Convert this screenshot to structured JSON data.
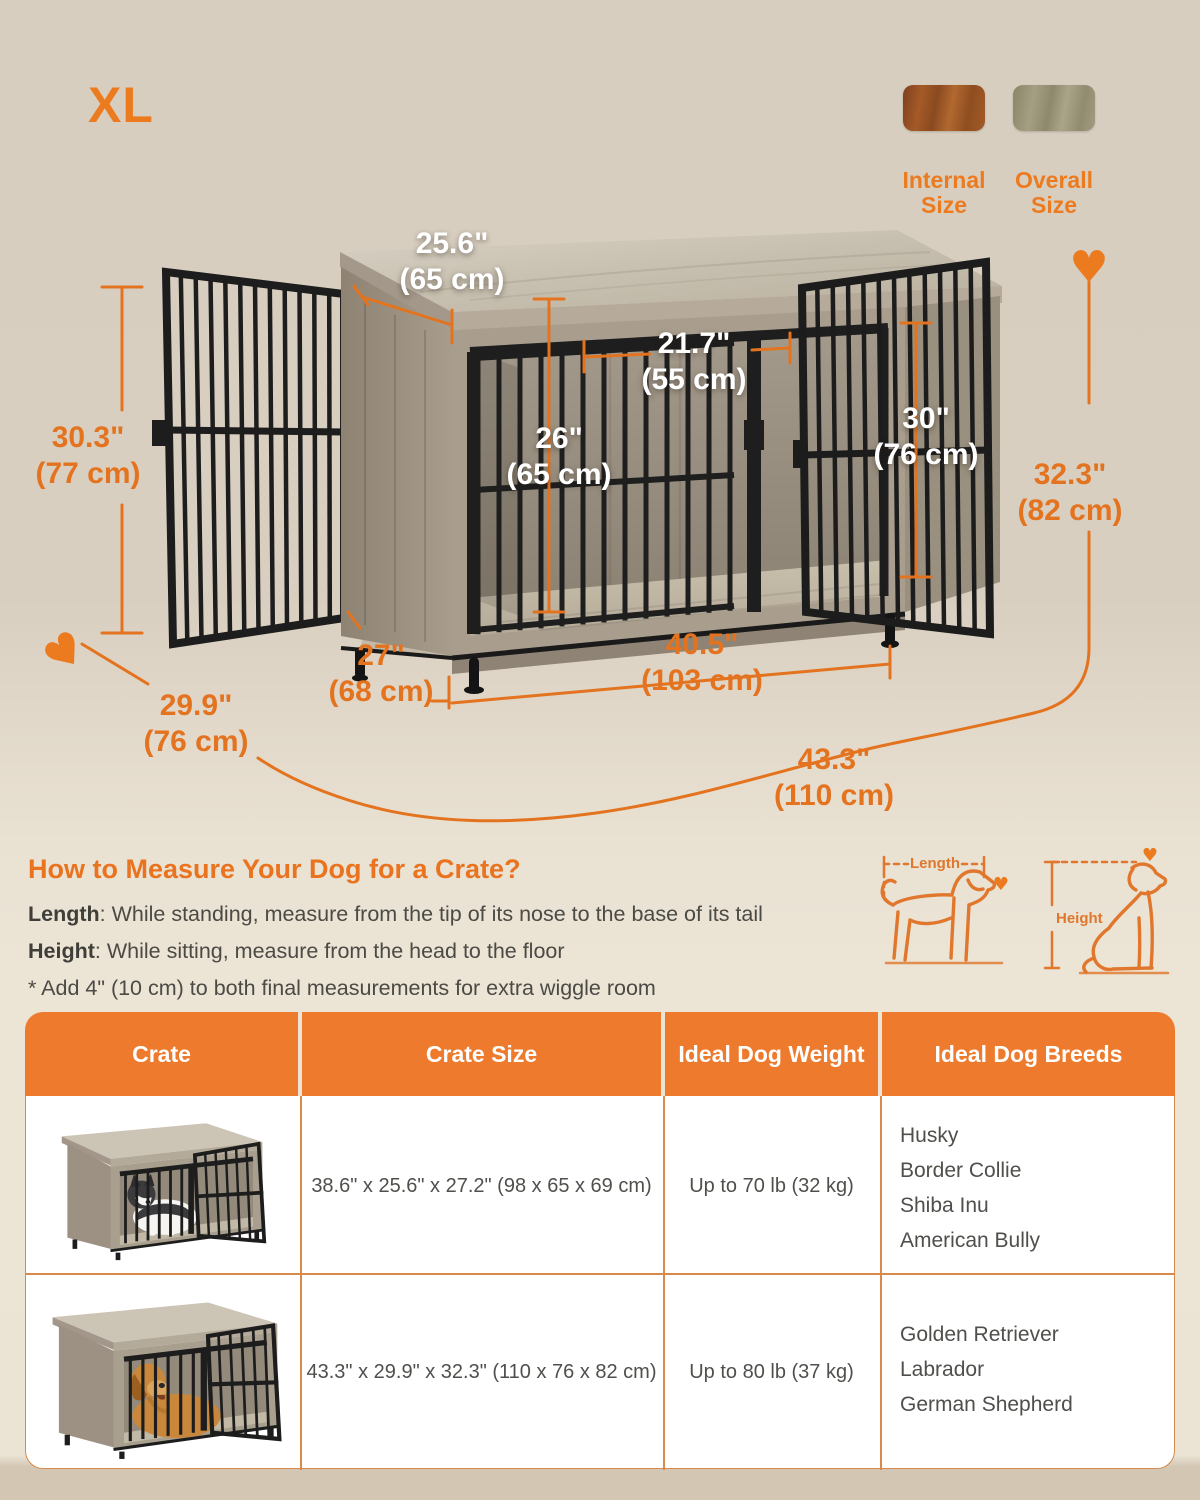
{
  "page": {
    "size_label": "XL"
  },
  "legend": {
    "internal": {
      "label": "Internal Size"
    },
    "overall": {
      "label": "Overall Size"
    }
  },
  "dimensions": {
    "top_depth": {
      "in": "25.6\"",
      "cm": "(65 cm)"
    },
    "door_width": {
      "in": "21.7\"",
      "cm": "(55 cm)"
    },
    "inner_height": {
      "in": "26\"",
      "cm": "(65 cm)"
    },
    "door_height": {
      "in": "30\"",
      "cm": "(76 cm)"
    },
    "left_height": {
      "in": "30.3\"",
      "cm": "(77 cm)"
    },
    "overall_height": {
      "in": "32.3\"",
      "cm": "(82 cm)"
    },
    "inner_depth": {
      "in": "27\"",
      "cm": "(68 cm)"
    },
    "inner_width": {
      "in": "40.5\"",
      "cm": "(103 cm)"
    },
    "overall_depth": {
      "in": "29.9\"",
      "cm": "(76 cm)"
    },
    "overall_width": {
      "in": "43.3\"",
      "cm": "(110 cm)"
    }
  },
  "measure": {
    "title": "How to Measure Your Dog for a Crate?",
    "length_label": "Length",
    "length_text": ":  While standing, measure from the tip of its nose to the base of its tail",
    "height_label": "Height",
    "height_text": ": While sitting, measure from the head to the floor",
    "note": "* Add 4\" (10 cm) to both final measurements for extra wiggle room",
    "diagram": {
      "length_label": "Length",
      "height_label": "Height"
    }
  },
  "table": {
    "headers": [
      "Crate",
      "Crate Size",
      "Ideal Dog Weight",
      "Ideal Dog Breeds"
    ],
    "rows": [
      {
        "size": "38.6\" x 25.6\" x 27.2\" (98 x 65 x 69 cm)",
        "weight": "Up to 70 lb (32 kg)",
        "breeds": [
          "Husky",
          "Border Collie",
          "Shiba Inu",
          "American Bully"
        ]
      },
      {
        "size": "43.3\" x 29.9\" x 32.3\" (110 x 76 x 82 cm)",
        "weight": "Up to 80 lb (37 kg)",
        "breeds": [
          "Golden Retriever",
          "Labrador",
          "German Shepherd"
        ]
      }
    ]
  },
  "colors": {
    "accent": "#e4731f",
    "table_header": "#ee7b2d",
    "background_top": "#d8cec0",
    "background_bottom": "#ece4d5",
    "text_dark": "#4b4a45"
  }
}
